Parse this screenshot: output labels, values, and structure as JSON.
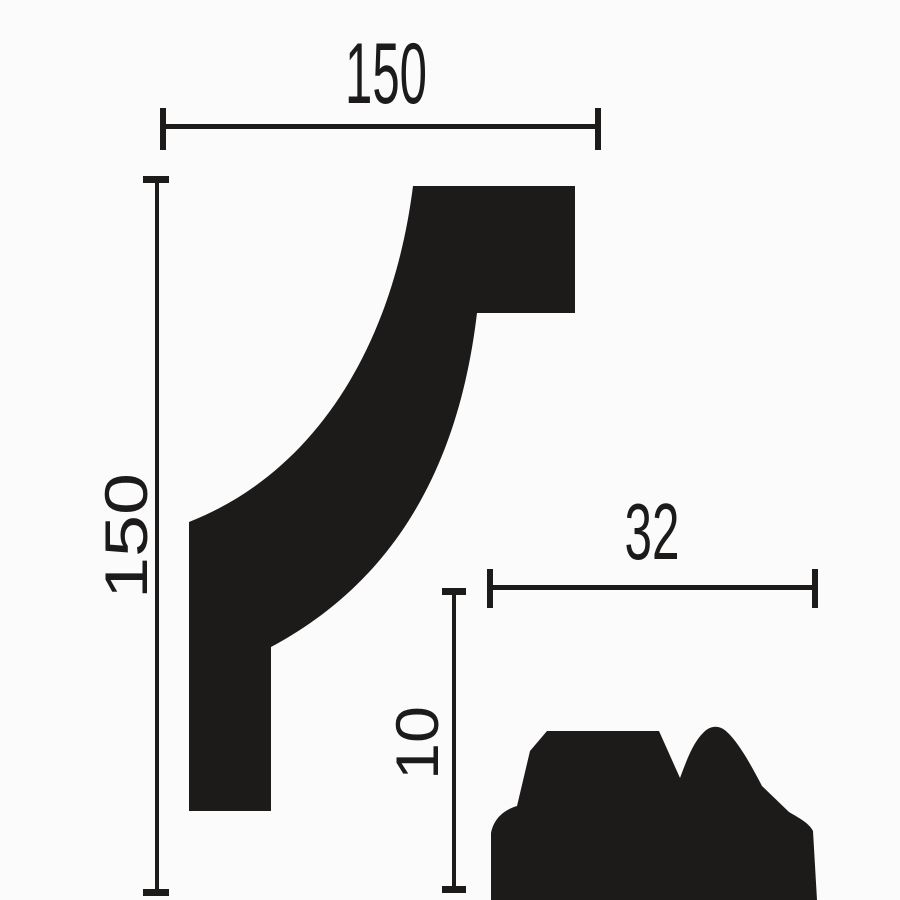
{
  "diagram": {
    "background_color": "#fbfbfb",
    "ink_color": "#1d1a1a",
    "large_profile": {
      "width_label": "150",
      "height_label": "150"
    },
    "small_profile": {
      "width_label": "32",
      "height_label": "10"
    }
  }
}
